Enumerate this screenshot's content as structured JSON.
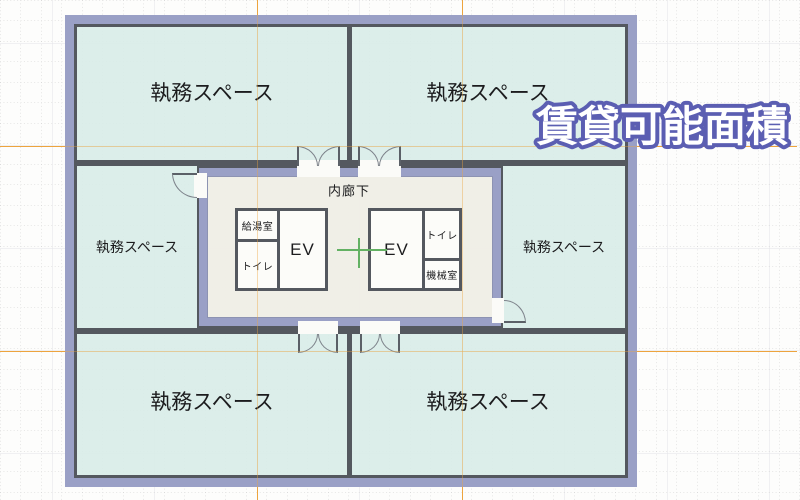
{
  "wordart": {
    "text": "賃貸可能面積",
    "fill": "#ffffff",
    "outline": "#5b5eb2"
  },
  "plan": {
    "offices": {
      "top_left": "執務スペース",
      "top_right": "執務スペース",
      "mid_left": "執務スペース",
      "mid_right": "執務スペース",
      "bottom_left": "執務スペース",
      "bottom_right": "執務スペース"
    },
    "core": {
      "corridor": "内廊下",
      "kitchenette": "給湯室",
      "toilet_left": "トイレ",
      "ev_left": "EV",
      "ev_right": "EV",
      "toilet_right": "トイレ",
      "machine_room": "機械室"
    }
  },
  "colors": {
    "office_fill": "#d8ece8",
    "core_fill": "#f0eee7",
    "wall_purple": "#9aa0c6",
    "wall_dark": "#54585f",
    "guide_orange": "#eda43f",
    "marker_green": "#63b163",
    "wordart_outline": "#5b5eb2"
  }
}
